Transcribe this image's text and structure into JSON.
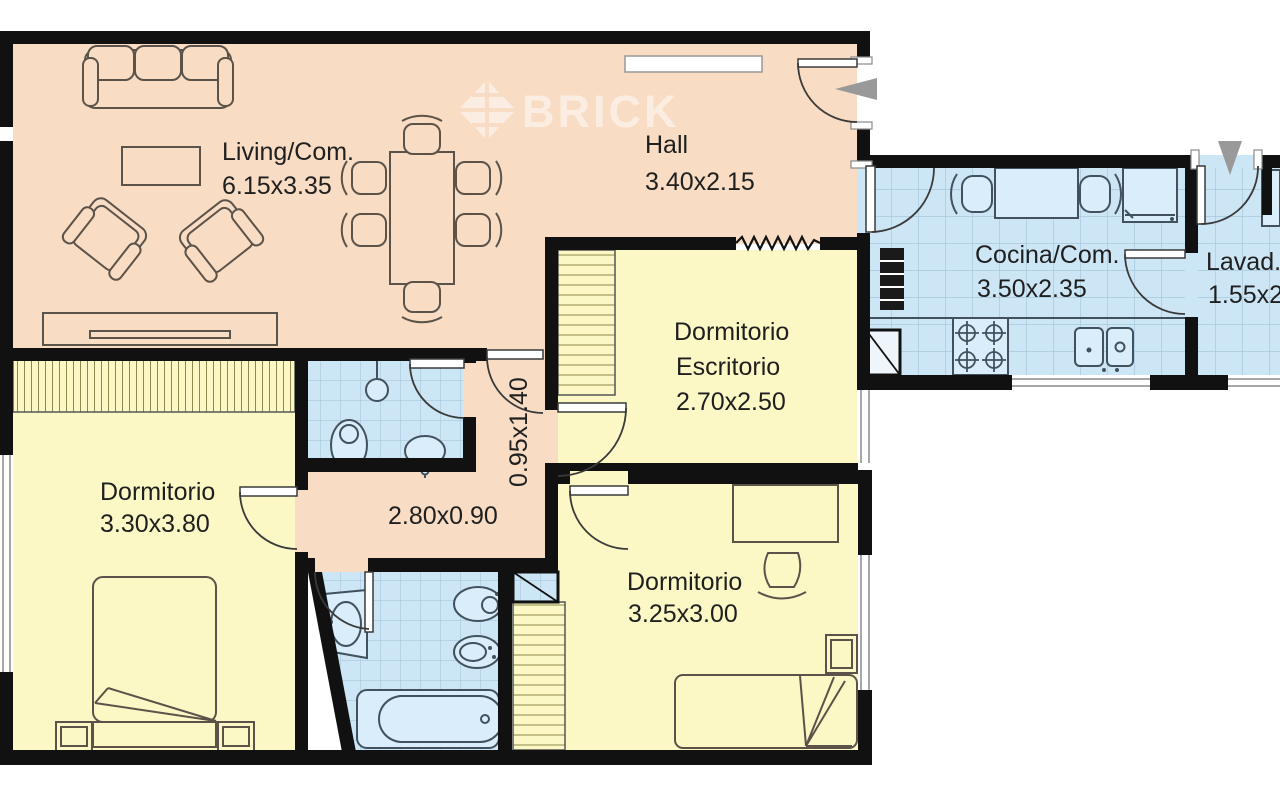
{
  "watermark": {
    "text": "BRICK"
  },
  "colors": {
    "living": "#f8dcc3",
    "bedroom": "#fbf8c5",
    "wet": "#cde6f6",
    "fixture": "#daedfa",
    "wall": "#111111",
    "furn": "#5b5349",
    "wetline": "#41525e",
    "grid": "#a6c8dc",
    "hatch": "#8f884f",
    "arrow": "#999999"
  },
  "rooms": {
    "living": {
      "label": "Living/Com.",
      "dims": "6.15x3.35"
    },
    "hall": {
      "label": "Hall",
      "dims": "3.40x2.15"
    },
    "bedroom_studio": {
      "label": "Dormitorio",
      "label2": "Escritorio",
      "dims": "2.70x2.50"
    },
    "kitchen": {
      "label": "Cocina/Com.",
      "dims": "3.50x2.35"
    },
    "laundry": {
      "label": "Lavad.",
      "dims": "1.55x2."
    },
    "bedroom_main": {
      "label": "Dormitorio",
      "dims": "3.30x3.80"
    },
    "bedroom_second": {
      "label": "Dormitorio",
      "dims": "3.25x3.00"
    },
    "hallway": {
      "dims": "2.80x0.90"
    },
    "passage": {
      "dims": "0.95x1.40"
    }
  }
}
